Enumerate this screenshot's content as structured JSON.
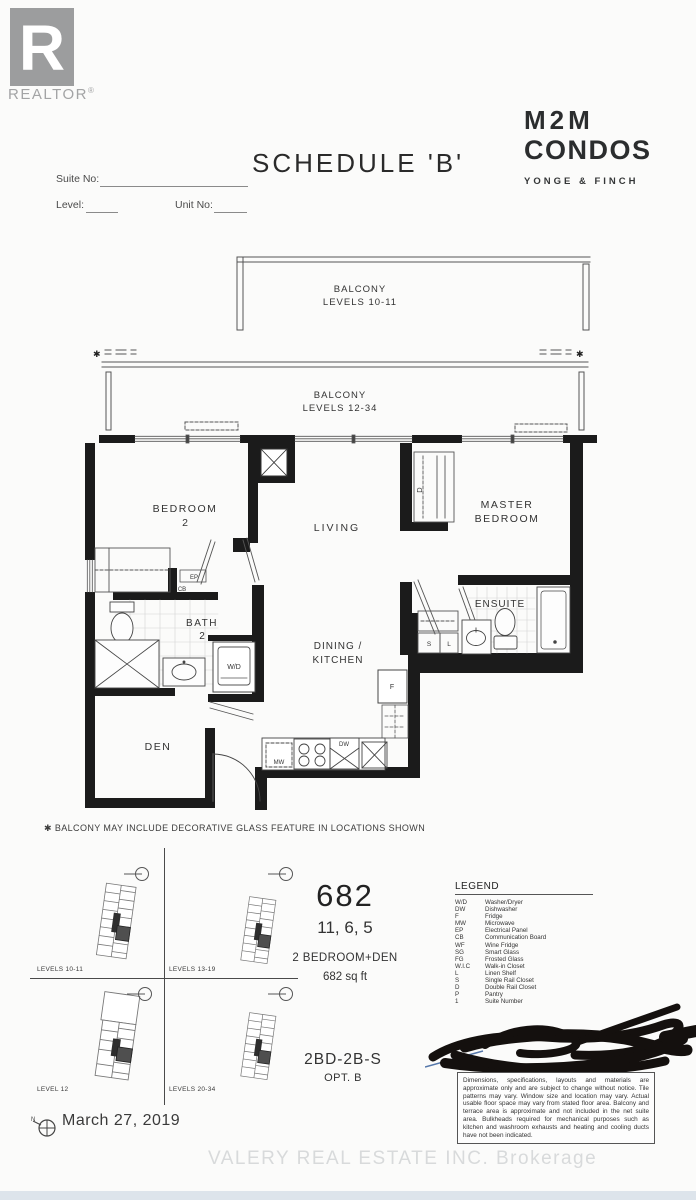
{
  "header": {
    "realtor_text": "REALTOR",
    "realtor_reg": "®",
    "schedule_title": "SCHEDULE 'B'",
    "brand_line1": "M2M",
    "brand_line2": "CONDOS",
    "brand_sub": "YONGE & FINCH"
  },
  "form": {
    "suite_no_label": "Suite No:",
    "level_label": "Level:",
    "unit_no_label": "Unit No:"
  },
  "floorplan": {
    "balcony_upper": {
      "title": "BALCONY",
      "levels": "LEVELS 10-11"
    },
    "balcony_lower": {
      "title": "BALCONY",
      "levels": "LEVELS 12-34"
    },
    "star": "✱",
    "labels": {
      "bedroom2": "BEDROOM",
      "bedroom2_num": "2",
      "living": "LIVING",
      "master1": "MASTER",
      "master2": "BEDROOM",
      "bath": "BATH",
      "bath_num": "2",
      "ensuite": "ENSUITE",
      "den": "DEN",
      "dining1": "DINING /",
      "dining2": "KITCHEN",
      "wd": "W/D",
      "ep": "EP",
      "cb": "CB",
      "d_closet": "D",
      "s_closet": "S",
      "l_closet": "L",
      "fridge": "F",
      "mw": "MW",
      "dw": "DW"
    },
    "footnote": "✱ BALCONY MAY INCLUDE DECORATIVE GLASS FEATURE IN LOCATIONS SHOWN"
  },
  "keyplans": {
    "plan1_label": "LEVELS 10-11",
    "plan2_label": "LEVELS 13-19",
    "plan3_label": "LEVEL 12",
    "plan4_label": "LEVELS 20-34"
  },
  "unit": {
    "number": "682",
    "suites": "11, 6, 5",
    "type": "2 BEDROOM+DEN",
    "area": "682 sq ft",
    "model": "2BD-2B-S",
    "option": "OPT. B"
  },
  "legend": {
    "title": "LEGEND",
    "items": [
      {
        "abbr": "W/D",
        "desc": "Washer/Dryer"
      },
      {
        "abbr": "DW",
        "desc": "Dishwasher"
      },
      {
        "abbr": "F",
        "desc": "Fridge"
      },
      {
        "abbr": "MW",
        "desc": "Microwave"
      },
      {
        "abbr": "EP",
        "desc": "Electrical Panel"
      },
      {
        "abbr": "CB",
        "desc": "Communication Board"
      },
      {
        "abbr": "WF",
        "desc": "Wine Fridge"
      },
      {
        "abbr": "SG",
        "desc": "Smart Glass"
      },
      {
        "abbr": "FG",
        "desc": "Frosted Glass"
      },
      {
        "abbr": "W.I.C",
        "desc": "Walk-in Closet"
      },
      {
        "abbr": "L",
        "desc": "Linen Shelf"
      },
      {
        "abbr": "S",
        "desc": "Single Rail Closet"
      },
      {
        "abbr": "D",
        "desc": "Double Rail Closet"
      },
      {
        "abbr": "P",
        "desc": "Pantry"
      },
      {
        "abbr": "1",
        "desc": "Suite Number"
      }
    ]
  },
  "disclaimer": "Dimensions, specifications, layouts and materials are approximate only and are subject to change without notice. Tile patterns may vary. Window size and location may vary. Actual usable floor space may vary from stated floor area. Balcony and terrace area is approximate and not included in the net suite area. Bulkheads required for mechanical purposes such as kitchen and washroom exhausts and heating and cooling ducts have not been indicated.",
  "footer": {
    "north_label": "N",
    "date": "March 27, 2019",
    "watermark": "VALERY REAL ESTATE INC.  Brokerage"
  }
}
